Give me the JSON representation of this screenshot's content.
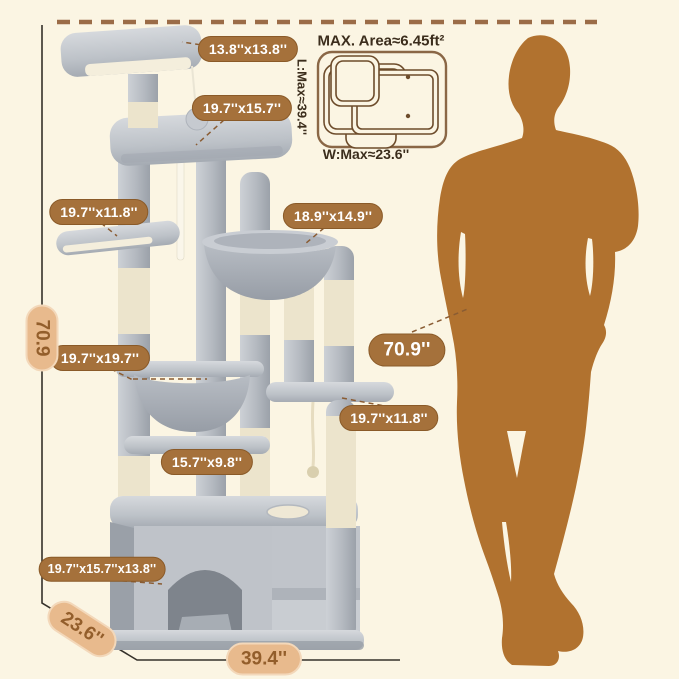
{
  "footprint_diagram": {
    "title": "MAX. Area≈6.45ft²",
    "length_label": "L:Max≈39.4''",
    "width_label": "W:Max≈23.6''"
  },
  "dimension_badges": {
    "top_perch": "13.8''x13.8''",
    "upper_platform": "19.7''x15.7''",
    "left_platform": "19.7''x11.8''",
    "right_hammock": "18.9''x14.9''",
    "middle_hammock": "19.7''x19.7''",
    "overall_height": "70.9''",
    "right_platform": "19.7''x11.8''",
    "lower_plank": "15.7''x9.8''",
    "condo": "19.7''x15.7''x13.8''"
  },
  "dimension_pills": {
    "height": "70.9",
    "depth": "23.6''",
    "width": "39.4''"
  },
  "colors": {
    "background_cream": "#fbf5e3",
    "badge_brown": "#a5713b",
    "pill_tan": "#e8ba8d",
    "pill_text_brown": "#935e2b",
    "silhouette_brown": "#b1722f",
    "dashed_border_brown": "#9b6c47",
    "dimension_line": "#35312a",
    "plush_gray": "#bfc3c9",
    "sisal_cream": "#f2ecd8"
  }
}
